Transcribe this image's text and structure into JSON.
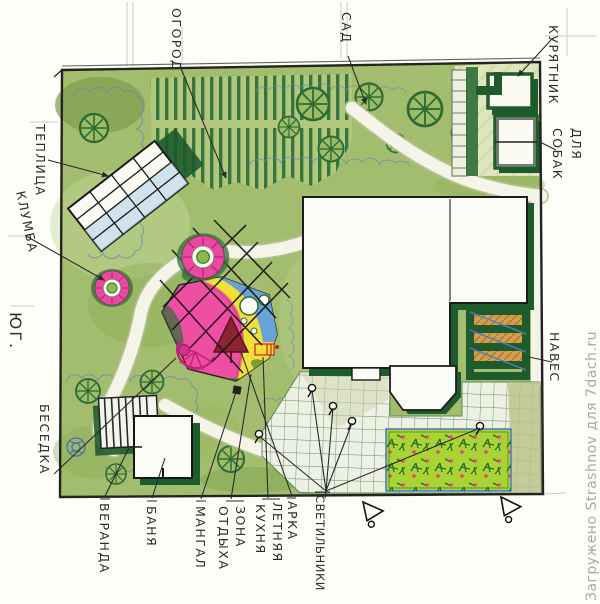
{
  "watermark": "Загружено Strashnov для 7dach.ru",
  "labels": {
    "ogorod": "ОГОРОД",
    "sad": "САД",
    "kuryatnik": "КУРЯТНИК",
    "dlya": "ДЛЯ",
    "sobak": "СОБАК",
    "teplitsa": "ТЕПЛИЦА",
    "klumba": "КЛУМБА",
    "yug": "ЮГ.",
    "besedka": "БЕСЕДКА",
    "veranda": "ВЕРАНДА",
    "banya": "БАНЯ",
    "mangal": "МАНГАЛ",
    "zona": "ЗОНА",
    "otdykha": "ОТДЫХА",
    "letnyaya": "ЛЕТНЯЯ",
    "kukhnya": "КУХНЯ",
    "arka": "АРКА",
    "svetilniki": "СВЕТИЛЬНИКИ",
    "naves": "НАВЕС"
  },
  "colors": {
    "lawn": "#a3bd6e",
    "lawn_dark": "#86a854",
    "lawn_light": "#c6d79a",
    "dark_green": "#1e5b2d",
    "tree_green": "#2e6b33",
    "row_green": "#2c6e35",
    "pink_zone": "#ee4fa2",
    "yellow_zone": "#f2e03a",
    "blue_zone": "#6aa3d8",
    "maroon_arch": "#8c2532",
    "flowerbed_green": "#aad334",
    "flower_pink": "#e8417e",
    "path_white": "#f4f4e9",
    "patio_base": "#edf0e3",
    "patio_grid": "#41804c",
    "courtyard": "#dfe5bd",
    "canopy_orange": "#dc9c4c",
    "pencil_blue": "#6b84b8",
    "ink": "#23231f",
    "watermark_gray": "#a5a5a3"
  }
}
